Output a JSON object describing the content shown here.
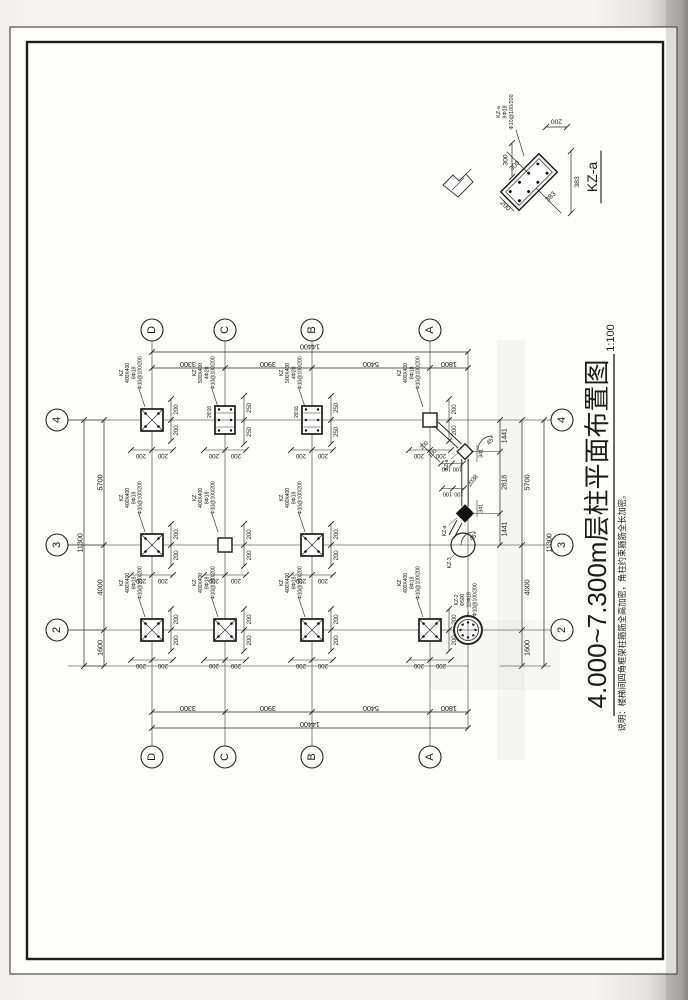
{
  "sheet": {
    "title": "4.000~7.300m层柱平面布置图",
    "scale": "1:100",
    "note": "说明：楼梯间四角框架柱箍筋全高加密，角柱约束箍筋全长加密。"
  },
  "grid": {
    "letters": [
      "D",
      "C",
      "B",
      "A"
    ],
    "numbers": [
      "4",
      "3",
      "2"
    ]
  },
  "dims": {
    "top": {
      "total": "14400",
      "segments": [
        "3300",
        "3900",
        "5400",
        "1800"
      ]
    },
    "bottom": {
      "total": "14400",
      "segments": [
        "3300",
        "3900",
        "5400",
        "1800"
      ]
    },
    "left": {
      "total": "11300",
      "segments": [
        "5700",
        "4000",
        "1600"
      ]
    },
    "right": {
      "total": "11300",
      "segments": [
        "5700",
        "4000",
        "1600"
      ],
      "stair_chain": [
        "1441",
        "2818",
        "1441"
      ]
    }
  },
  "columns": {
    "kz400_label": [
      "KZ",
      "400X400",
      "8Φ18",
      "Φ10@100/200"
    ],
    "kz500_label": [
      "KZ",
      "500X400",
      "4Φ20",
      "Φ10@100/200"
    ],
    "kz500_note": "2Φ16",
    "d200": "200",
    "d250": "250",
    "layout": [
      {
        "id": "D4",
        "type": "tied",
        "label": "kz400"
      },
      {
        "id": "C4",
        "type": "rect",
        "label": "kz500"
      },
      {
        "id": "B4",
        "type": "rect",
        "label": "kz500"
      },
      {
        "id": "A4",
        "type": "open",
        "label": "kz400"
      },
      {
        "id": "D3",
        "type": "tied",
        "label": "kz400"
      },
      {
        "id": "C3",
        "type": "open",
        "label": "kz400"
      },
      {
        "id": "B3",
        "type": "tied",
        "label": "kz400"
      },
      {
        "id": "D2",
        "type": "tied",
        "label": "kz400"
      },
      {
        "id": "C2",
        "type": "tied",
        "label": "kz400"
      },
      {
        "id": "B2",
        "type": "tied",
        "label": "kz400"
      },
      {
        "id": "A2",
        "type": "tied",
        "label": "kz400"
      }
    ]
  },
  "special": {
    "kz2_label": [
      "KZ-2",
      "Φ500",
      "12Φ18",
      "Φ10@100/200"
    ],
    "kz3_label": "KZ-3",
    "kza_label": "KZ-a",
    "stair": {
      "d100": "100",
      "d200": "200",
      "d341": "341",
      "d2038": "2038",
      "angle": "45°"
    }
  },
  "detail": {
    "title": "KZ-a",
    "label": [
      "KZ-a",
      "8Φ18",
      "Φ10@100/200"
    ],
    "dims": {
      "d200": "200",
      "d300": "300",
      "d383": "383"
    }
  }
}
